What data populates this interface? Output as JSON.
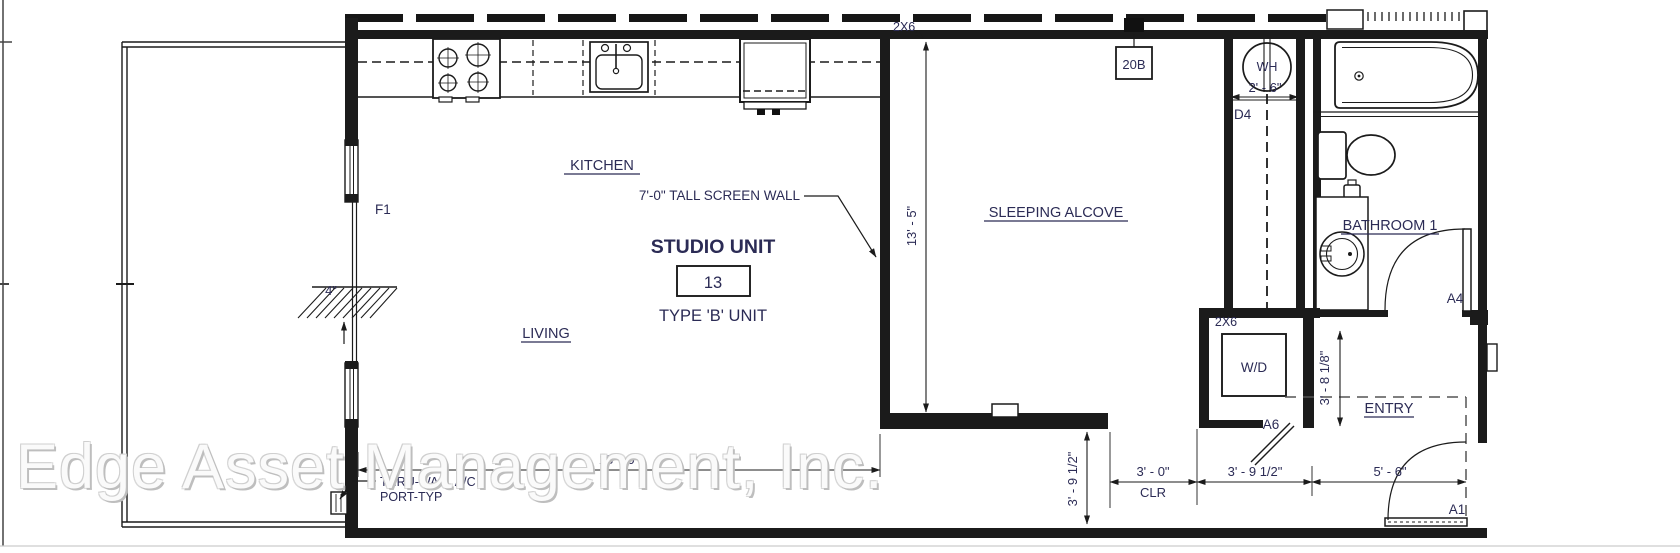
{
  "watermark": {
    "text": "Edge Asset Management, Inc."
  },
  "rooms": {
    "kitchen": "KITCHEN",
    "living": "LIVING",
    "alcove": "SLEEPING ALCOVE",
    "bathroom": "BATHROOM 1",
    "entry": "ENTRY"
  },
  "unit": {
    "title": "STUDIO UNIT",
    "number": "13",
    "type": "TYPE 'B' UNIT"
  },
  "fixtures": {
    "wh": "WH",
    "wd": "W/D"
  },
  "notes": {
    "screen_wall": "7'-0\" TALL SCREEN WALL",
    "ac1": "THRU-WALL A/C",
    "ac2": "PORT-TYP",
    "framing_top": "2X6",
    "framing_wd": "2X6",
    "panel": "20B"
  },
  "tags": {
    "window": "F1",
    "closet_door": "D4",
    "bath_door": "A4",
    "wd_door": "A6",
    "entry_door": "A1"
  },
  "dims": {
    "alcove_h": "13' - 5\"",
    "living_w": "18' - 0\"",
    "wh_w": "2' - 6\"",
    "slab": "4\"",
    "hall_v": "3' - 9 1/2\"",
    "clear_w": "3' - 0\"",
    "clear_lbl": "CLR",
    "wd_w": "3' - 9 1/2\"",
    "entry_w": "5' - 6\"",
    "entry_d": "3' - 8 1/8\""
  }
}
